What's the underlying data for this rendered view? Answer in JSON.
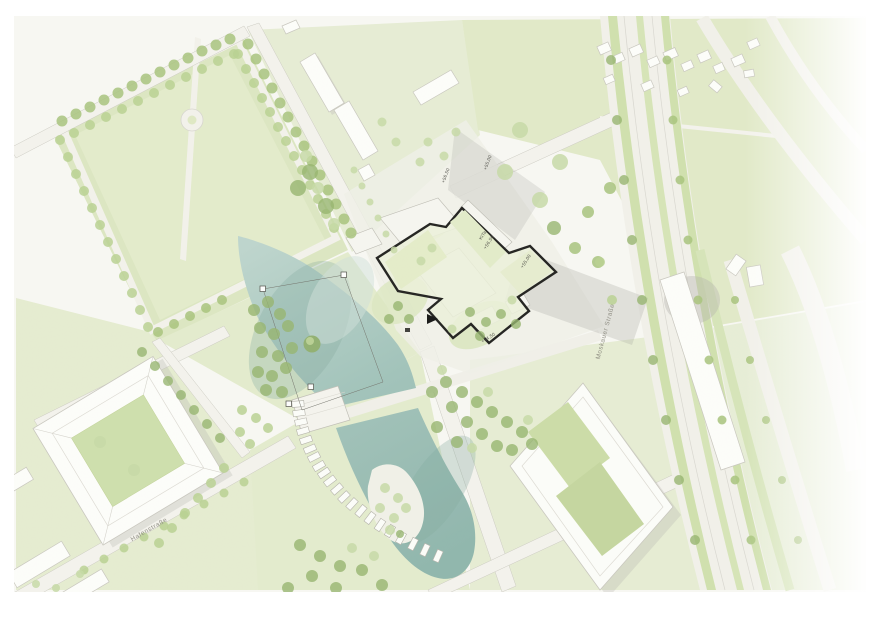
{
  "labels": {
    "street_southwest": "Hafenstraße",
    "street_east": "Moskauer Straße",
    "level_north_a": "+56,50",
    "level_north_b": "+55,00",
    "building_name": "KiTa",
    "building_level": "+56,50",
    "wing_level": "+55,00",
    "south_level": "+54,50"
  },
  "colors": {
    "water": "#9fc1b9",
    "water_deep": "#7ea69d",
    "green_field": "#e2eaca",
    "green_median": "#cfe0ac",
    "tree": "#a3bf7a",
    "street": "#f3f2ec",
    "building": "#fefefc",
    "site_outline": "#1c1c1a",
    "shadow": "#b5b4ae",
    "label_gray": "#8b897f"
  }
}
